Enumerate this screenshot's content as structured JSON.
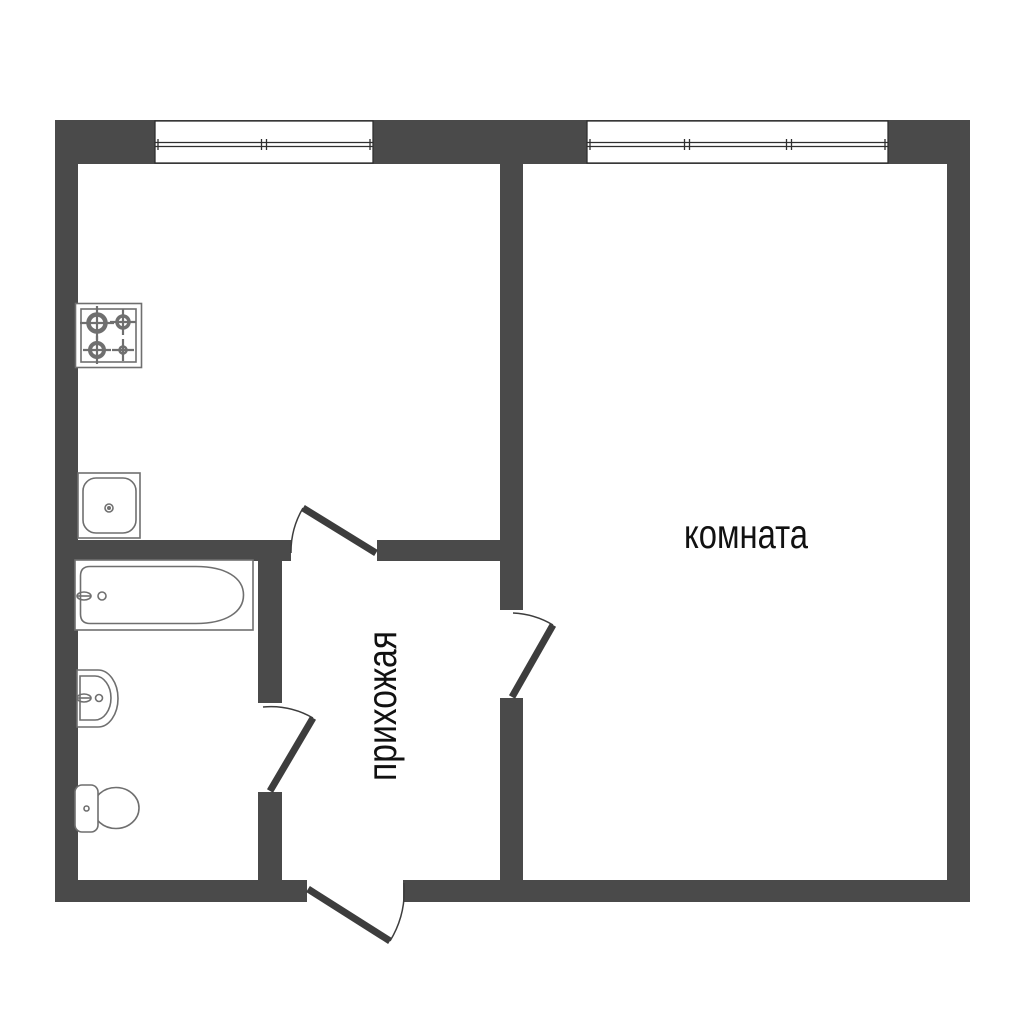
{
  "floor_plan": {
    "labels": {
      "room": "комната",
      "hallway": "прихожая"
    },
    "colors": {
      "background": "#ffffff",
      "wall": "#4a4a4a",
      "window_frame": "#2f2f2f",
      "door": "#3d3d3d",
      "fixture_outline": "#6f6f6f",
      "label_text": "#111111"
    },
    "windows": [
      {
        "name": "kitchen-window",
        "panes": 2
      },
      {
        "name": "room-window",
        "panes": 3
      }
    ],
    "doors": [
      {
        "name": "kitchen-door"
      },
      {
        "name": "bathroom-door"
      },
      {
        "name": "room-door"
      },
      {
        "name": "entrance-door"
      }
    ],
    "fixtures": [
      {
        "name": "stove",
        "burners": 4
      },
      {
        "name": "kitchen-sink"
      },
      {
        "name": "bathtub"
      },
      {
        "name": "washbasin"
      },
      {
        "name": "toilet"
      }
    ]
  }
}
